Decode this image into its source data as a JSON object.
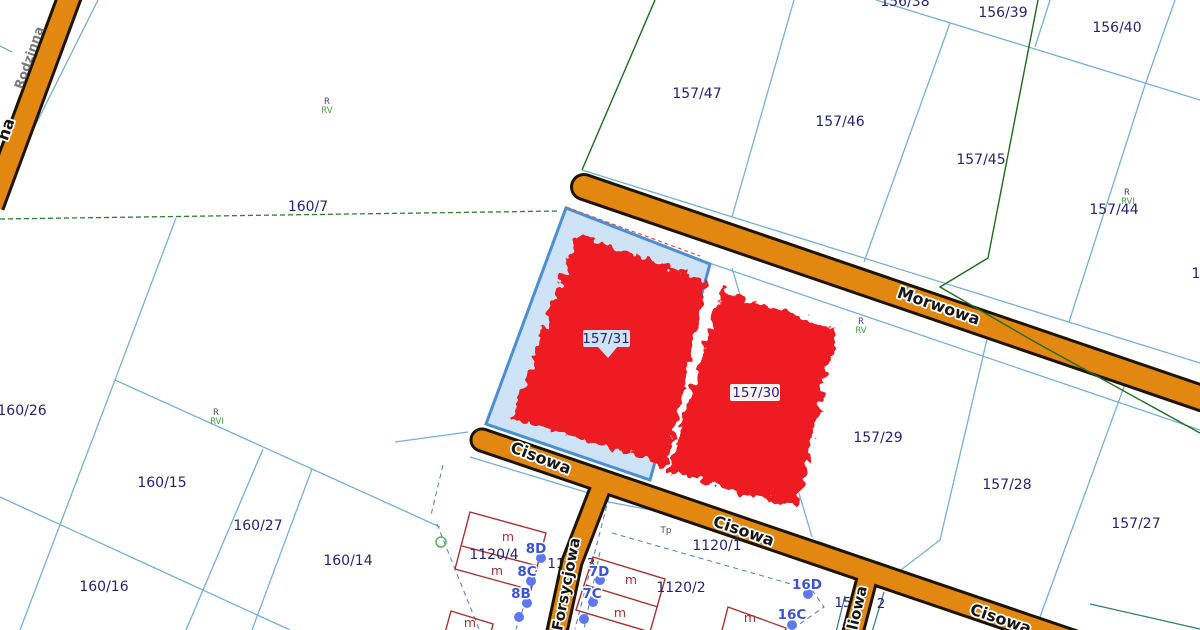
{
  "map": {
    "type": "cadastral-parcel-map",
    "selected_parcels": [
      "157/31",
      "157/30"
    ],
    "colors": {
      "background": "#ffffff",
      "parcel_line": "#74b0d8",
      "dashed_line": "#5b85c8",
      "road_fill": "#e2870f",
      "road_casing": "#1d1400",
      "selection_fill": "#cfe3f7",
      "selection_stroke": "#4a8ed6",
      "highlight_red": "#ee1b23",
      "parcel_text": "#23237d",
      "house_number_text": "#3a52d8",
      "address_dot": "#5d78f2",
      "building_outline": "#aa3030",
      "green_boundary": "#1d6b1d",
      "soil_class_green": "#3da23d",
      "street_text": "#161616"
    },
    "streets": [
      {
        "t": "Morwowa",
        "x": 937,
        "y": 311,
        "r": 19,
        "cls": "t-street"
      },
      {
        "t": "Cisowa",
        "x": 539,
        "y": 463,
        "r": 21,
        "cls": "t-street"
      },
      {
        "t": "Cisowa",
        "x": 742,
        "y": 536,
        "r": 19,
        "cls": "t-street"
      },
      {
        "t": "Cisowa",
        "x": 999,
        "y": 624,
        "r": 19,
        "cls": "t-street"
      },
      {
        "t": "Forsycjowa",
        "x": 571,
        "y": 585,
        "r": -79,
        "cls": "t-street-sm"
      },
      {
        "t": "liowa",
        "x": 862,
        "y": 609,
        "r": -77,
        "cls": "t-street-sm"
      },
      {
        "t": "na",
        "x": 11,
        "y": 131,
        "r": -71,
        "cls": "t-street"
      },
      {
        "t": "Rodzinna",
        "x": 33,
        "y": 59,
        "r": -71,
        "cls": "t-street-dim"
      }
    ],
    "parcel_labels": [
      {
        "t": "156/38",
        "x": 905,
        "y": 6,
        "cls": "t-parcel"
      },
      {
        "t": "156/39",
        "x": 1003,
        "y": 17,
        "cls": "t-parcel"
      },
      {
        "t": "156/40",
        "x": 1117,
        "y": 32,
        "cls": "t-parcel"
      },
      {
        "t": "157/47",
        "x": 697,
        "y": 98,
        "cls": "t-parcel"
      },
      {
        "t": "157/46",
        "x": 840,
        "y": 126,
        "cls": "t-parcel"
      },
      {
        "t": "157/45",
        "x": 981,
        "y": 164,
        "cls": "t-parcel"
      },
      {
        "t": "157/44",
        "x": 1114,
        "y": 214,
        "cls": "t-parcel"
      },
      {
        "t": "160/7",
        "x": 308,
        "y": 211,
        "cls": "t-parcel"
      },
      {
        "t": "160/26",
        "x": 22,
        "y": 415,
        "cls": "t-parcel"
      },
      {
        "t": "160/15",
        "x": 162,
        "y": 487,
        "cls": "t-parcel"
      },
      {
        "t": "160/27",
        "x": 258,
        "y": 530,
        "cls": "t-parcel"
      },
      {
        "t": "160/14",
        "x": 348,
        "y": 565,
        "cls": "t-parcel"
      },
      {
        "t": "160/16",
        "x": 104,
        "y": 591,
        "cls": "t-parcel"
      },
      {
        "t": "157/31",
        "x": 606,
        "y": 343,
        "cls": "t-parcel-sm"
      },
      {
        "t": "157/30",
        "x": 756,
        "y": 397,
        "cls": "t-parcel-sm"
      },
      {
        "t": "157/29",
        "x": 878,
        "y": 442,
        "cls": "t-parcel"
      },
      {
        "t": "157/28",
        "x": 1007,
        "y": 489,
        "cls": "t-parcel"
      },
      {
        "t": "157/27",
        "x": 1136,
        "y": 528,
        "cls": "t-parcel"
      },
      {
        "t": "1120/4",
        "x": 494,
        "y": 559,
        "cls": "t-parcel"
      },
      {
        "t": "1120/1",
        "x": 717,
        "y": 550,
        "cls": "t-parcel"
      },
      {
        "t": "1120/2",
        "x": 681,
        "y": 592,
        "cls": "t-parcel"
      },
      {
        "t": "1",
        "x": 1196,
        "y": 278,
        "cls": "t-parcel"
      }
    ],
    "partial_labels": [
      {
        "t": "11",
        "x": 556,
        "y": 568
      },
      {
        "t": "3",
        "x": 591,
        "y": 568
      },
      {
        "t": "15",
        "x": 843,
        "y": 607
      },
      {
        "t": "2",
        "x": 881,
        "y": 608
      },
      {
        "t": "22",
        "x": 803,
        "y": 548
      }
    ],
    "house_numbers": [
      {
        "t": "8D",
        "x": 536,
        "y": 553
      },
      {
        "t": "8C",
        "x": 527,
        "y": 576
      },
      {
        "t": "8B",
        "x": 521,
        "y": 598
      },
      {
        "t": "7D",
        "x": 599,
        "y": 576
      },
      {
        "t": "7C",
        "x": 592,
        "y": 598
      },
      {
        "t": "16D",
        "x": 807,
        "y": 589
      },
      {
        "t": "16C",
        "x": 792,
        "y": 619
      }
    ],
    "soil_labels": [
      {
        "t": "R",
        "x": 327,
        "y": 104,
        "cls": "t-soil-r"
      },
      {
        "t": "RV",
        "x": 327,
        "y": 113,
        "cls": "t-soil-c"
      },
      {
        "t": "R",
        "x": 216,
        "y": 415,
        "cls": "t-soil-r"
      },
      {
        "t": "RVI",
        "x": 217,
        "y": 424,
        "cls": "t-soil-c"
      },
      {
        "t": "R",
        "x": 861,
        "y": 324,
        "cls": "t-soil-r"
      },
      {
        "t": "RV",
        "x": 861,
        "y": 333,
        "cls": "t-soil-c"
      },
      {
        "t": "R",
        "x": 1127,
        "y": 195,
        "cls": "t-soil-r"
      },
      {
        "t": "RVI",
        "x": 1128,
        "y": 204,
        "cls": "t-soil-c"
      }
    ],
    "misc_labels": [
      {
        "t": "Tp",
        "x": 666,
        "y": 533,
        "cls": "t-tp"
      }
    ],
    "building_marks": [
      {
        "t": "m",
        "x": 508,
        "y": 541
      },
      {
        "t": "m",
        "x": 497,
        "y": 575
      },
      {
        "t": "m",
        "x": 631,
        "y": 584
      },
      {
        "t": "m",
        "x": 620,
        "y": 617
      },
      {
        "t": "m",
        "x": 750,
        "y": 622
      },
      {
        "t": "m",
        "x": 470,
        "y": 627
      }
    ],
    "buildings": [
      {
        "pts": "470,512 546,533 531,590 455,569",
        "inner": "462,546 538,566"
      },
      {
        "pts": "593,557 665,579 650,632 576,610",
        "inner": "586,585 658,607"
      },
      {
        "pts": "728,607 786,628 779,652 721,634",
        "inner": ""
      },
      {
        "pts": "451,611 493,624 486,652 443,640",
        "inner": ""
      }
    ],
    "address_dots": [
      [
        541,
        558
      ],
      [
        531,
        581
      ],
      [
        527,
        603
      ],
      [
        519,
        617
      ],
      [
        600,
        580
      ],
      [
        593,
        602
      ],
      [
        584,
        619
      ],
      [
        808,
        594
      ],
      [
        792,
        625
      ]
    ]
  }
}
